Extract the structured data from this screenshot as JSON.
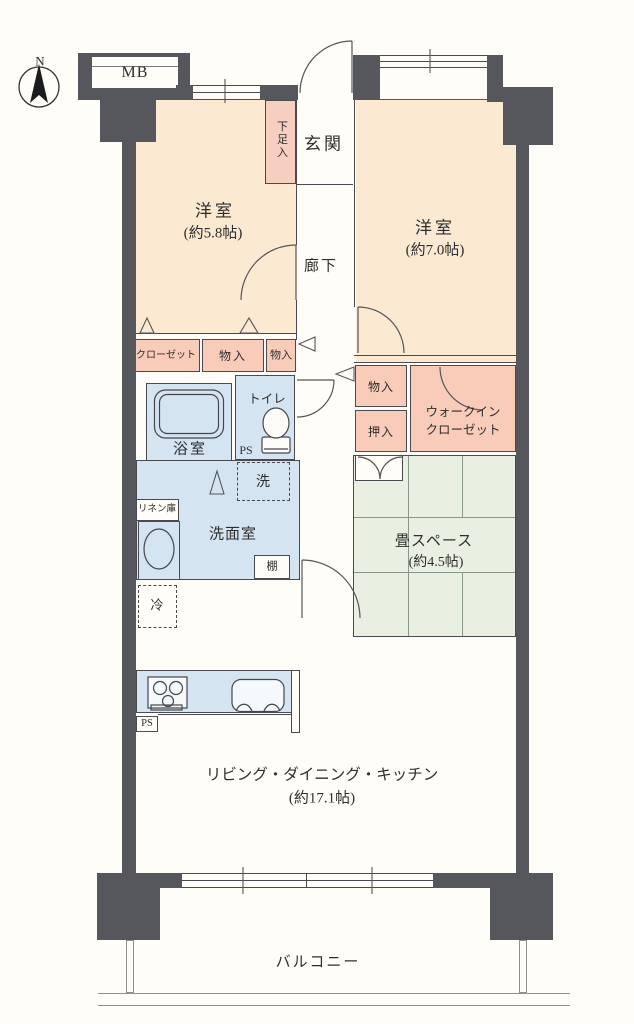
{
  "labels": {
    "north": "N",
    "mb": "MB",
    "entrance": "玄関",
    "shoe_cabinet": "下足入",
    "bedroom1_name": "洋室",
    "bedroom1_size": "(約5.8帖)",
    "bedroom2_name": "洋室",
    "bedroom2_size": "(約7.0帖)",
    "corridor": "廊下",
    "closet": "クローゼット",
    "storage_a": "物入",
    "storage_b": "物入",
    "storage_c": "物入",
    "oshiire": "押入",
    "wic_line1": "ウォークイン",
    "wic_line2": "クローゼット",
    "toilet": "トイレ",
    "bath": "浴室",
    "ps_upper": "PS",
    "laundry": "洗",
    "linen": "リネン庫",
    "washroom": "洗面室",
    "shelf": "棚",
    "tatami_name": "畳スペース",
    "tatami_size": "(約4.5帖)",
    "fridge": "冷",
    "ldk_name": "リビング・ダイニング・キッチン",
    "ldk_size": "(約17.1帖)",
    "ps_lower": "PS",
    "balcony": "バルコニー"
  },
  "colors": {
    "wall": "#56575c",
    "room": "#fbe9d2",
    "closet": "#f8ccb8",
    "wet_area": "#d4e4f1",
    "tatami": "#e9f0e2",
    "outline": "#4a4b50",
    "background": "#fffdf7"
  }
}
